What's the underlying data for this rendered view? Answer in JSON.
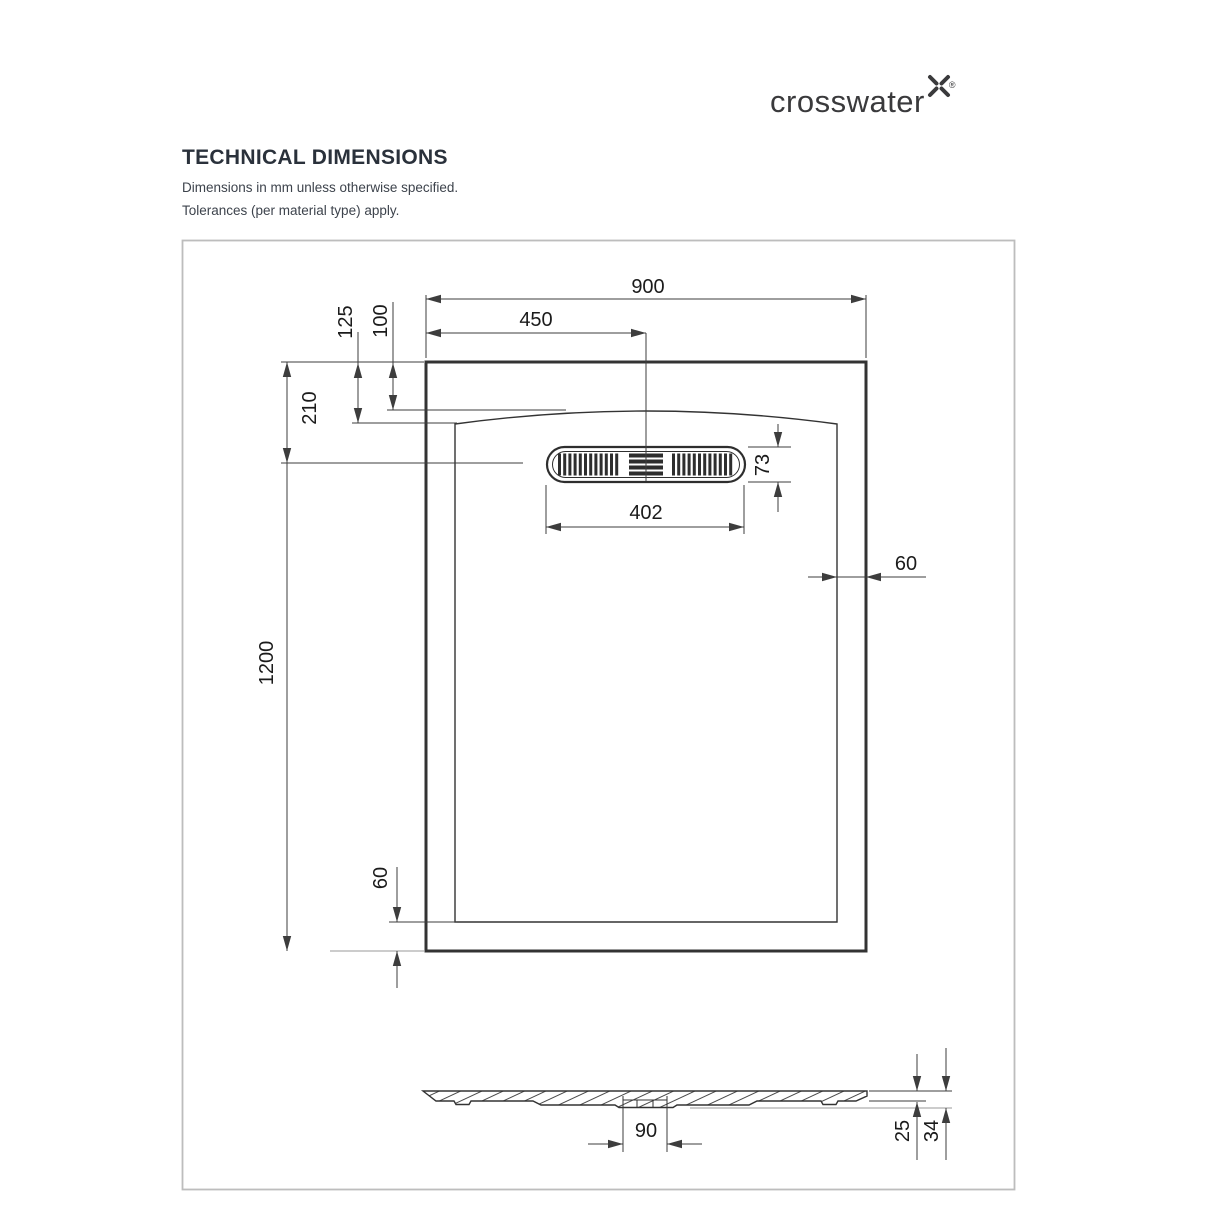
{
  "brand": {
    "name": "crosswater",
    "registered_mark": "®"
  },
  "header": {
    "title": "TECHNICAL DIMENSIONS",
    "notes": {
      "line1": "Dimensions in mm unless otherwise specified.",
      "line2": "Tolerances (per material type) apply."
    }
  },
  "colors": {
    "drawing_line": "#333333",
    "dimension_line": "#3d3d3d",
    "dimension_text": "#1b1b1b",
    "frame_border": "#bdbdbd",
    "brand_text": "#3a3a3c",
    "title_text": "#2a313b"
  },
  "plan_view": {
    "dims": {
      "overall_width": "900",
      "drain_center_from_left": "450",
      "rim_to_basin_corner": "125",
      "rim_to_basin_arc": "100",
      "rim_to_drain_center": "210",
      "overall_length": "1200",
      "drain_cover_depth": "73",
      "drain_cover_length": "402",
      "rim_width_right": "60",
      "rim_width_bottom": "60"
    }
  },
  "section_view": {
    "dims": {
      "waste_recess_width": "90",
      "edge_thickness": "25",
      "overall_thickness": "34"
    }
  }
}
